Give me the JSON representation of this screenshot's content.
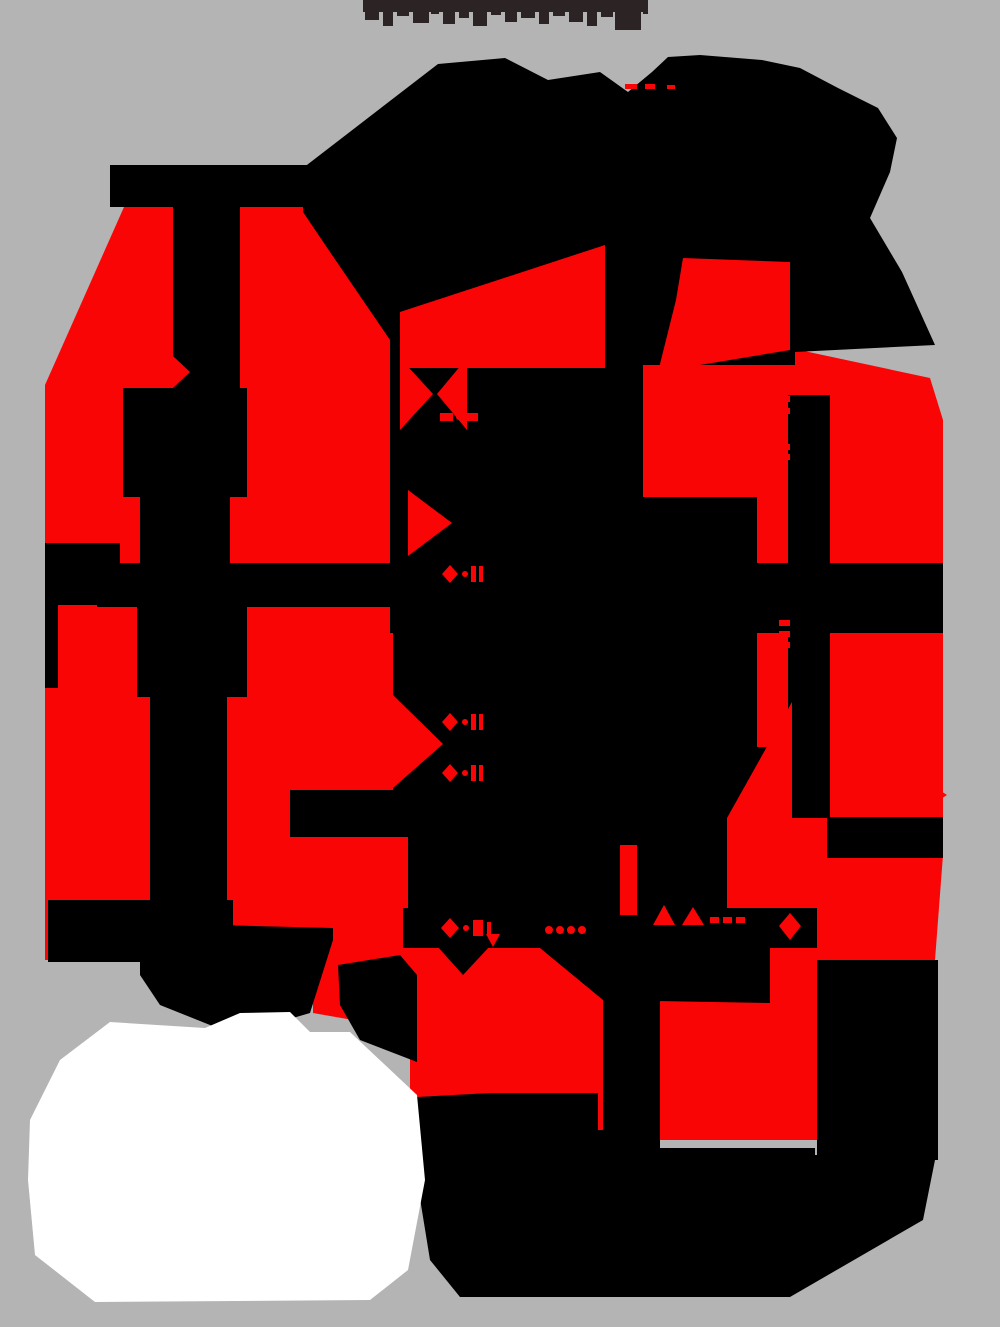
{
  "canvas": {
    "width": 1000,
    "height": 1327
  },
  "palette": {
    "bg": "#b4b4b4",
    "red": "#fa0505",
    "black": "#000000",
    "white": "#ffffff",
    "ink": "#2b2324"
  },
  "shapes": [
    {
      "name": "title-text-strip",
      "fill": "ink",
      "type": "rect",
      "x": 363,
      "y": 0,
      "w": 285,
      "h": 12
    },
    {
      "name": "title-glyph-tooth",
      "fill": "ink",
      "type": "rect",
      "x": 365,
      "y": 0,
      "w": 14,
      "h": 20
    },
    {
      "name": "title-glyph-tooth",
      "fill": "ink",
      "type": "rect",
      "x": 383,
      "y": 0,
      "w": 10,
      "h": 26
    },
    {
      "name": "title-glyph-tooth",
      "fill": "ink",
      "type": "rect",
      "x": 397,
      "y": 0,
      "w": 12,
      "h": 16
    },
    {
      "name": "title-glyph-tooth",
      "fill": "ink",
      "type": "rect",
      "x": 413,
      "y": 0,
      "w": 16,
      "h": 23
    },
    {
      "name": "title-glyph-tooth",
      "fill": "ink",
      "type": "rect",
      "x": 431,
      "y": 0,
      "w": 8,
      "h": 14
    },
    {
      "name": "title-glyph-tooth",
      "fill": "ink",
      "type": "rect",
      "x": 443,
      "y": 0,
      "w": 12,
      "h": 24
    },
    {
      "name": "title-glyph-tooth",
      "fill": "ink",
      "type": "rect",
      "x": 459,
      "y": 0,
      "w": 10,
      "h": 18
    },
    {
      "name": "title-glyph-tooth",
      "fill": "ink",
      "type": "rect",
      "x": 473,
      "y": 0,
      "w": 14,
      "h": 26
    },
    {
      "name": "title-glyph-tooth",
      "fill": "ink",
      "type": "rect",
      "x": 491,
      "y": 0,
      "w": 10,
      "h": 15
    },
    {
      "name": "title-glyph-tooth",
      "fill": "ink",
      "type": "rect",
      "x": 505,
      "y": 0,
      "w": 12,
      "h": 22
    },
    {
      "name": "title-glyph-tooth",
      "fill": "ink",
      "type": "rect",
      "x": 521,
      "y": 0,
      "w": 14,
      "h": 18
    },
    {
      "name": "title-glyph-tooth",
      "fill": "ink",
      "type": "rect",
      "x": 539,
      "y": 0,
      "w": 10,
      "h": 24
    },
    {
      "name": "title-glyph-tooth",
      "fill": "ink",
      "type": "rect",
      "x": 553,
      "y": 0,
      "w": 12,
      "h": 16
    },
    {
      "name": "title-glyph-tooth",
      "fill": "ink",
      "type": "rect",
      "x": 569,
      "y": 0,
      "w": 14,
      "h": 22
    },
    {
      "name": "title-glyph-tooth",
      "fill": "ink",
      "type": "rect",
      "x": 587,
      "y": 0,
      "w": 10,
      "h": 26
    },
    {
      "name": "title-glyph-tooth",
      "fill": "ink",
      "type": "rect",
      "x": 601,
      "y": 0,
      "w": 12,
      "h": 17
    },
    {
      "name": "title-glyph-tooth",
      "fill": "ink",
      "type": "rect",
      "x": 615,
      "y": 0,
      "w": 26,
      "h": 30
    },
    {
      "name": "title-glyph-tooth",
      "fill": "ink",
      "type": "rect",
      "x": 643,
      "y": 0,
      "w": 5,
      "h": 14
    },
    {
      "name": "red-zone-west",
      "fill": "red",
      "type": "polygon",
      "points": "128,198 800,198 800,960 45,960 45,385"
    },
    {
      "name": "red-zone-south",
      "fill": "red",
      "type": "polygon",
      "points": "313,900 817,900 817,1140 595,1140 595,1100 410,1100 410,1030 313,1013"
    },
    {
      "name": "red-zone-east",
      "fill": "red",
      "type": "polygon",
      "points": "790,348 930,378 943,420 943,855 935,960 880,1005 790,1005"
    },
    {
      "name": "black-t-bar-north",
      "fill": "black",
      "type": "polygon",
      "points": "110,165 307,165 307,207 110,207"
    },
    {
      "name": "black-upper-blob",
      "fill": "black",
      "type": "polygon",
      "points": "303,212 303,168 438,64 505,58 548,80 600,72 628,92 652,72 668,57 700,55 762,60 800,68 838,88 878,108 897,138 890,172 870,218 902,272 935,345 795,352 795,365 455,365 390,340 330,252"
    },
    {
      "name": "black-t-stem-north",
      "fill": "black",
      "type": "polygon",
      "points": "173,203 240,203 240,392 173,392"
    },
    {
      "name": "black-west-knob",
      "fill": "black",
      "type": "polygon",
      "points": "123,388 247,388 247,497 123,497"
    },
    {
      "name": "black-west-column-upper",
      "fill": "black",
      "type": "polygon",
      "points": "140,497 230,497 230,615 140,615"
    },
    {
      "name": "black-west-arm",
      "fill": "black",
      "type": "polygon",
      "points": "45,543 120,543 120,605 45,605"
    },
    {
      "name": "black-west-bridge",
      "fill": "black",
      "type": "polygon",
      "points": "97,563 400,563 400,607 97,607"
    },
    {
      "name": "black-west-sliver",
      "fill": "black",
      "type": "polygon",
      "points": "45,603 58,603 58,688 45,688"
    },
    {
      "name": "black-west-knob2",
      "fill": "black",
      "type": "polygon",
      "points": "137,607 247,607 247,697 137,697"
    },
    {
      "name": "black-west-column-lower",
      "fill": "black",
      "type": "polygon",
      "points": "150,697 227,697 227,928 150,928"
    },
    {
      "name": "black-southwest-block",
      "fill": "black",
      "type": "polygon",
      "points": "48,900 233,900 233,962 48,962"
    },
    {
      "name": "black-southwest-band",
      "fill": "black",
      "type": "polygon",
      "points": "140,923 333,928 333,940 310,1013 235,1035 160,1005 140,975"
    },
    {
      "name": "black-center-col-left",
      "fill": "black",
      "type": "polygon",
      "points": "390,330 455,330 455,500 390,500"
    },
    {
      "name": "black-center-upper",
      "fill": "black",
      "type": "polygon",
      "points": "390,365 643,365 643,565 390,565"
    },
    {
      "name": "black-center-right-step",
      "fill": "black",
      "type": "polygon",
      "points": "643,497 757,497 757,565 643,565"
    },
    {
      "name": "black-center-bar-mid",
      "fill": "black",
      "type": "polygon",
      "points": "605,240 633,240 633,330 605,330"
    },
    {
      "name": "black-corridor",
      "fill": "black",
      "type": "polygon",
      "points": "390,563 943,563 943,633 390,633"
    },
    {
      "name": "black-center-mid",
      "fill": "black",
      "type": "polygon",
      "points": "393,633 757,633 757,818 393,818"
    },
    {
      "name": "black-west-stub",
      "fill": "black",
      "type": "polygon",
      "points": "290,790 408,790 408,837 290,837"
    },
    {
      "name": "black-center-lower",
      "fill": "black",
      "type": "polygon",
      "points": "408,818 727,818 727,945 408,945"
    },
    {
      "name": "black-south-band",
      "fill": "black",
      "type": "polygon",
      "points": "403,908 817,908 817,948 403,948"
    },
    {
      "name": "black-notch-v",
      "fill": "black",
      "type": "polygon",
      "points": "437,946 490,946 463,975"
    },
    {
      "name": "black-south-blob",
      "fill": "black",
      "type": "polygon",
      "points": "338,965 400,955 417,975 417,1062 360,1040 340,1005"
    },
    {
      "name": "black-east-bar",
      "fill": "black",
      "type": "polygon",
      "points": "788,395 830,395 830,818 788,818"
    },
    {
      "name": "black-east-knob",
      "fill": "black",
      "type": "polygon",
      "points": "750,747 807,747 807,807 750,807"
    },
    {
      "name": "black-east-block-a",
      "fill": "black",
      "type": "polygon",
      "points": "827,817 943,817 943,858 827,858"
    },
    {
      "name": "black-east-block-b",
      "fill": "black",
      "type": "polygon",
      "points": "817,960 938,960 938,1160 817,1160"
    },
    {
      "name": "black-south-t-bar",
      "fill": "black",
      "type": "polygon",
      "points": "540,948 770,948 770,1003 603,1000"
    },
    {
      "name": "black-south-t-stem",
      "fill": "black",
      "type": "polygon",
      "points": "603,1000 660,1000 660,1145 603,1145"
    },
    {
      "name": "black-south-mass",
      "fill": "black",
      "type": "polygon",
      "points": "417,1097 490,1093 598,1093 598,1130 660,1130 660,1148 815,1148 815,1155 935,1155 935,1160 923,1220 790,1297 460,1297 430,1260 417,1180"
    },
    {
      "name": "white-basin",
      "fill": "white",
      "type": "polygon",
      "points": "30,1120 60,1060 110,1022 205,1028 240,1013 290,1012 310,1032 350,1032 417,1095 425,1180 408,1270 370,1300 95,1302 35,1255 28,1180"
    },
    {
      "name": "red-window-a",
      "fill": "red",
      "type": "polygon",
      "points": "605,245 605,368 400,368 400,312"
    },
    {
      "name": "red-window-b",
      "fill": "red",
      "type": "polygon",
      "points": "683,258 790,262 790,350 658,372 676,300"
    },
    {
      "name": "red-bowtie-left",
      "fill": "red",
      "type": "polygon",
      "points": "400,358 400,430 433,394"
    },
    {
      "name": "red-bowtie-right",
      "fill": "red",
      "type": "polygon",
      "points": "467,358 467,430 437,394"
    },
    {
      "name": "red-stem-notch",
      "fill": "red",
      "type": "polygon",
      "points": "173,356 173,388 190,372"
    },
    {
      "name": "red-wedge-mid",
      "fill": "red",
      "type": "polygon",
      "points": "408,490 408,556 452,523"
    },
    {
      "name": "red-wedge-low",
      "fill": "red",
      "type": "polygon",
      "points": "393,695 393,788 443,744"
    },
    {
      "name": "red-slot",
      "fill": "red",
      "type": "rect",
      "x": 620,
      "y": 845,
      "w": 17,
      "h": 70
    },
    {
      "name": "red-wedge-east",
      "fill": "red",
      "type": "polygon",
      "points": "727,818 792,702 792,818"
    },
    {
      "name": "red-tip-east",
      "fill": "red",
      "type": "polygon",
      "points": "933,786 947,795 933,804"
    },
    {
      "name": "marker-dash",
      "fill": "red",
      "type": "rect",
      "x": 440,
      "y": 413,
      "w": 13,
      "h": 8
    },
    {
      "name": "marker-dot",
      "fill": "red",
      "type": "circle",
      "cx": 459,
      "cy": 417,
      "r": 3
    },
    {
      "name": "marker-dash",
      "fill": "red",
      "type": "rect",
      "x": 467,
      "y": 413,
      "w": 11,
      "h": 8
    },
    {
      "name": "marker-diamond",
      "fill": "red",
      "type": "polygon",
      "points": "442,574 450,565 458,574 450,583"
    },
    {
      "name": "marker-dot",
      "fill": "red",
      "type": "circle",
      "cx": 465,
      "cy": 574,
      "r": 3
    },
    {
      "name": "marker-bar",
      "fill": "red",
      "type": "rect",
      "x": 471,
      "y": 566,
      "w": 5,
      "h": 16
    },
    {
      "name": "marker-bar",
      "fill": "red",
      "type": "rect",
      "x": 479,
      "y": 566,
      "w": 4,
      "h": 16
    },
    {
      "name": "marker-diamond",
      "fill": "red",
      "type": "polygon",
      "points": "442,722 450,713 458,722 450,731"
    },
    {
      "name": "marker-dot",
      "fill": "red",
      "type": "circle",
      "cx": 465,
      "cy": 722,
      "r": 3
    },
    {
      "name": "marker-bar",
      "fill": "red",
      "type": "rect",
      "x": 471,
      "y": 714,
      "w": 5,
      "h": 16
    },
    {
      "name": "marker-bar",
      "fill": "red",
      "type": "rect",
      "x": 479,
      "y": 714,
      "w": 4,
      "h": 16
    },
    {
      "name": "marker-diamond",
      "fill": "red",
      "type": "polygon",
      "points": "442,773 450,764 458,773 450,782"
    },
    {
      "name": "marker-dot",
      "fill": "red",
      "type": "circle",
      "cx": 465,
      "cy": 773,
      "r": 3
    },
    {
      "name": "marker-bar",
      "fill": "red",
      "type": "rect",
      "x": 471,
      "y": 765,
      "w": 5,
      "h": 16
    },
    {
      "name": "marker-bar",
      "fill": "red",
      "type": "rect",
      "x": 479,
      "y": 765,
      "w": 4,
      "h": 16
    },
    {
      "name": "marker-diamond",
      "fill": "red",
      "type": "polygon",
      "points": "441,928 450,918 459,928 450,938"
    },
    {
      "name": "marker-dot",
      "fill": "red",
      "type": "circle",
      "cx": 466,
      "cy": 928,
      "r": 3
    },
    {
      "name": "marker-square",
      "fill": "red",
      "type": "rect",
      "x": 473,
      "y": 920,
      "w": 10,
      "h": 16
    },
    {
      "name": "marker-bar",
      "fill": "red",
      "type": "rect",
      "x": 487,
      "y": 922,
      "w": 4,
      "h": 12
    },
    {
      "name": "marker-pointer",
      "fill": "red",
      "type": "polygon",
      "points": "486,934 500,934 493,947"
    },
    {
      "name": "marker-dot-row",
      "fill": "red",
      "type": "circle",
      "cx": 549,
      "cy": 930,
      "r": 4
    },
    {
      "name": "marker-dot-row",
      "fill": "red",
      "type": "circle",
      "cx": 560,
      "cy": 930,
      "r": 4
    },
    {
      "name": "marker-dot-row",
      "fill": "red",
      "type": "circle",
      "cx": 571,
      "cy": 930,
      "r": 4
    },
    {
      "name": "marker-dot-row",
      "fill": "red",
      "type": "circle",
      "cx": 582,
      "cy": 930,
      "r": 4
    },
    {
      "name": "marker-triangle",
      "fill": "red",
      "type": "polygon",
      "points": "653,925 664,905 675,925"
    },
    {
      "name": "marker-triangle",
      "fill": "red",
      "type": "polygon",
      "points": "682,925 693,907 704,925"
    },
    {
      "name": "marker-dash",
      "fill": "red",
      "type": "rect",
      "x": 710,
      "y": 917,
      "w": 9,
      "h": 6
    },
    {
      "name": "marker-dash",
      "fill": "red",
      "type": "rect",
      "x": 723,
      "y": 917,
      "w": 9,
      "h": 6
    },
    {
      "name": "marker-dash",
      "fill": "red",
      "type": "rect",
      "x": 736,
      "y": 917,
      "w": 9,
      "h": 6
    },
    {
      "name": "marker-diamond-east",
      "fill": "red",
      "type": "polygon",
      "points": "790,913 801,926 790,940 779,926"
    },
    {
      "name": "bar-mark",
      "fill": "red",
      "type": "rect",
      "x": 779,
      "y": 386,
      "w": 11,
      "h": 6
    },
    {
      "name": "bar-mark",
      "fill": "red",
      "type": "rect",
      "x": 779,
      "y": 396,
      "w": 11,
      "h": 6
    },
    {
      "name": "bar-mark",
      "fill": "red",
      "type": "rect",
      "x": 779,
      "y": 408,
      "w": 11,
      "h": 6
    },
    {
      "name": "bar-mark",
      "fill": "red",
      "type": "rect",
      "x": 779,
      "y": 444,
      "w": 11,
      "h": 6
    },
    {
      "name": "bar-mark",
      "fill": "red",
      "type": "rect",
      "x": 779,
      "y": 454,
      "w": 11,
      "h": 6
    },
    {
      "name": "bar-mark",
      "fill": "red",
      "type": "rect",
      "x": 779,
      "y": 620,
      "w": 11,
      "h": 6
    },
    {
      "name": "bar-mark",
      "fill": "red",
      "type": "rect",
      "x": 779,
      "y": 631,
      "w": 11,
      "h": 6
    },
    {
      "name": "bar-mark",
      "fill": "red",
      "type": "rect",
      "x": 779,
      "y": 642,
      "w": 11,
      "h": 6
    },
    {
      "name": "marker-x-diamond",
      "fill": "red",
      "type": "polygon",
      "points": "770,758 785,777 770,796 755,777"
    },
    {
      "name": "top-edge-dash",
      "fill": "red",
      "type": "rect",
      "x": 625,
      "y": 84,
      "w": 12,
      "h": 5
    },
    {
      "name": "top-edge-dash",
      "fill": "red",
      "type": "rect",
      "x": 645,
      "y": 84,
      "w": 10,
      "h": 5
    },
    {
      "name": "top-edge-dash",
      "fill": "red",
      "type": "rect",
      "x": 667,
      "y": 85,
      "w": 8,
      "h": 4
    }
  ]
}
